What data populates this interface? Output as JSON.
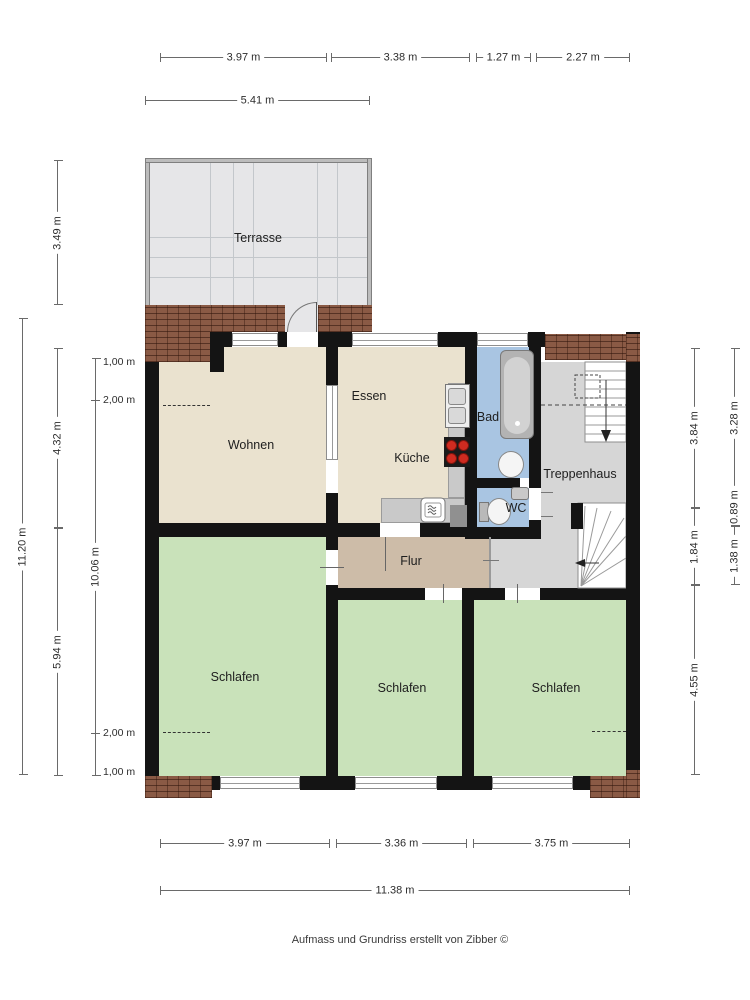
{
  "rooms": {
    "terrasse": "Terrasse",
    "wohnen": "Wohnen",
    "essen": "Essen",
    "kueche": "Küche",
    "bad": "Bad",
    "wc": "WC",
    "treppenhaus": "Treppenhaus",
    "flur": "Flur",
    "schlafen_left": "Schlafen",
    "schlafen_middle": "Schlafen",
    "schlafen_right": "Schlafen"
  },
  "dimensions": {
    "top": [
      "3.97 m",
      "3.38 m",
      "1.27 m",
      "2.27 m"
    ],
    "top2": "5.41 m",
    "bottom": [
      "3.97 m",
      "3.36 m",
      "3.75 m"
    ],
    "bottom_total": "11.38 m",
    "left_total": "11.20 m",
    "left_outer": [
      "3.49 m",
      "4.32 m",
      "5.94 m"
    ],
    "left_inner": "10.06 m",
    "left_marks": [
      "1,00 m",
      "2,00 m",
      "2,00 m",
      "1,00 m"
    ],
    "right_inner": [
      "3.84 m",
      "1.84 m",
      "4.55 m"
    ],
    "right_outer": [
      "3.28 m",
      "0.89 m",
      "1.38 m"
    ]
  },
  "footer": {
    "credit": "Aufmass und Grundriss erstellt von Zibber ©"
  },
  "icons": {
    "bathtub": "bathtub-icon",
    "toilet": "toilet-icon",
    "sink": "sink-icon",
    "stove": "stove-icon",
    "dishwasher": "dishwasher-icon",
    "stairs": "stairs-icon"
  },
  "colors": {
    "wall": "#141414",
    "living": "#eae2cf",
    "bedroom": "#c9e2ba",
    "bath": "#a9c5e2",
    "hall": "#cdbca8",
    "stairwell": "#d6d6d6",
    "terrace": "#e6e6e8",
    "brick": "#8a5a45"
  }
}
